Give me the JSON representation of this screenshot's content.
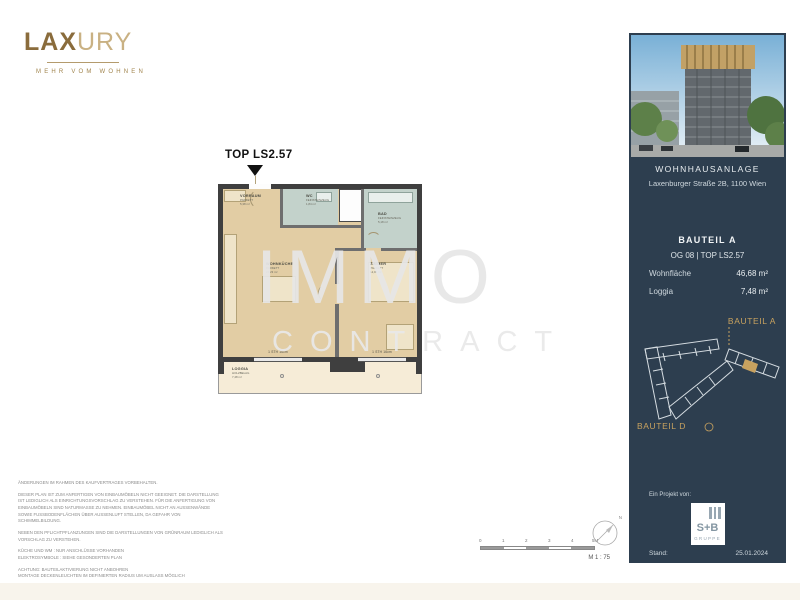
{
  "brand": {
    "wordmark_bold": "LAX",
    "wordmark_light": "URY",
    "tagline": "MEHR VOM WOHNEN",
    "gold_dark": "#8a6c3c",
    "gold_light": "#c9b183"
  },
  "plan": {
    "unit_label": "TOP LS2.57",
    "rooms": [
      {
        "name": "VORRAUM",
        "material": "PARKETT",
        "area": "5,38 m²"
      },
      {
        "name": "WC",
        "material": "FEINSTEINZEUG",
        "area": "1,84 m²"
      },
      {
        "name": "BAD",
        "material": "FEINSTEINZEUG",
        "area": "5,18 m²"
      },
      {
        "name": "WOHNKÜCHE",
        "material": "PARKETT",
        "area": "22,23 m²"
      },
      {
        "name": "ZIMMER",
        "material": "PARKETT",
        "area": "12,05 m²"
      },
      {
        "name": "LOGGIA",
        "material": "HOLZBELAG",
        "area": "7,48 m²"
      }
    ],
    "window_notes": [
      "1 STH 16cm",
      "1 STH 16cm"
    ],
    "colors": {
      "floor": "#e2cda4",
      "tile": "#c3d2cb",
      "loggia": "#f6ecd7",
      "wall": "#3f3f3f"
    }
  },
  "watermark": {
    "line1": "IMMO",
    "line2": "CONTRACT"
  },
  "disclaimer": [
    "ÄNDERUNGEN IM RAHMEN DES KAUFVERTRAGES VORBEHALTEN.",
    "DIESER PLAN IST ZUM ANFERTIGEN VON EINBAUMÖBELN NICHT GEEIGNET. DIE DARSTELLUNG IST LEDIGLICH ALS EINRICHTUNGSVORSCHLAG ZU VERSTEHEN. FÜR DIE ANFERTIGUNG VON EINBAUMÖBELN SIND NATURMASSE ZU NEHMEN. EINBAUMÖBEL NICHT AN AUSSENWÄNDE SOWIE FUSSBODENFLÄCHEN ÜBER AUSSENLUFT STELLEN, DA GEFAHR VON SCHIMMELBILDUNG.",
    "NEBEN DEN PFLICHTPFLANZUNGEN SIND DIE DARSTELLUNGEN VON GRÜNRAUM LEDIGLICH ALS VORSCHLAG ZU VERSTEHEN.",
    "KÜCHE UND WM : NUR ANSCHLÜSSE VORHANDEN\nELEKTROSYMBOLE : SIEHE GESONDERTEN PLAN",
    "ACHTUNG: BAUTEILAKTIVIERUNG NICHT ANBOHREN\nMONTAGE DECKENLEUCHTEN IM DEFINIERTEN RADIUS UM AUSLASS MÖGLICH"
  ],
  "scale": {
    "ticks": [
      "0",
      "1",
      "2",
      "3",
      "4",
      "5M"
    ],
    "ratio_label": "M 1 : 75",
    "north_label": "N"
  },
  "sidebar": {
    "background": "#2d3e4f",
    "accent_gold": "#c8a25f",
    "project_title": "WOHNHAUSANLAGE",
    "project_address": "Laxenburger Straße 2B, 1100 Wien",
    "bauteil": "BAUTEIL A",
    "floor_unit": "OG 08 | TOP LS2.57",
    "area_rows": [
      {
        "label": "Wohnfläche",
        "value": "46,68 m²"
      },
      {
        "label": "Loggia",
        "value": "7,48 m²"
      }
    ],
    "siteplan": {
      "label_a": "BAUTEIL A",
      "label_d": "BAUTEIL D"
    },
    "footer": {
      "project_by": "Ein Projekt von:",
      "logo_main": "S+B",
      "logo_sub": "GRUPPE",
      "stand_label": "Stand:",
      "stand_date": "25.01.2024"
    }
  }
}
